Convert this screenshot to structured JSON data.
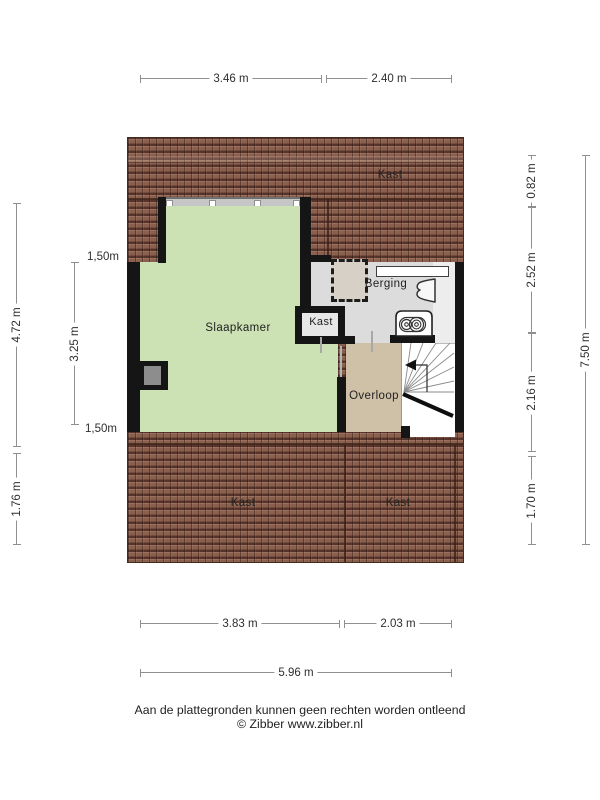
{
  "floorplan": {
    "room_labels": {
      "slaapkamer": "Slaapkamer",
      "berging": "Berging",
      "kast_attic_top": "Kast",
      "kast_closet": "Kast",
      "overloop": "Overloop",
      "kast_attic_bottom_left": "Kast",
      "kast_attic_bottom_right": "Kast"
    },
    "colors": {
      "room_green": "#cce1b4",
      "room_grey": "#dcdcdc",
      "room_tan": "#cfc0a8",
      "roof_tile_brown": "#8a5f4e",
      "wall_black": "#151515"
    },
    "icons": [
      "roof-window",
      "shelf",
      "ventilation-unit",
      "boiler",
      "stairs",
      "chimney"
    ]
  },
  "dimensions": {
    "top": [
      "3.46 m",
      "2.40 m"
    ],
    "bottom": [
      "3.83 m",
      "2.03 m"
    ],
    "bottom_total": "5.96 m",
    "left_outer": [
      "4.72 m",
      "1.76 m"
    ],
    "left_inner": "3.25 m",
    "left_inner_ends": [
      "1,50m",
      "1,50m"
    ],
    "right_inner": [
      "0.82 m",
      "2.52 m",
      "2.16 m",
      "1.70 m"
    ],
    "right_total": "7.50 m"
  },
  "footer": {
    "disclaimer": "Aan de plattegronden kunnen geen rechten worden ontleend",
    "credit": "© Zibber www.zibber.nl"
  }
}
